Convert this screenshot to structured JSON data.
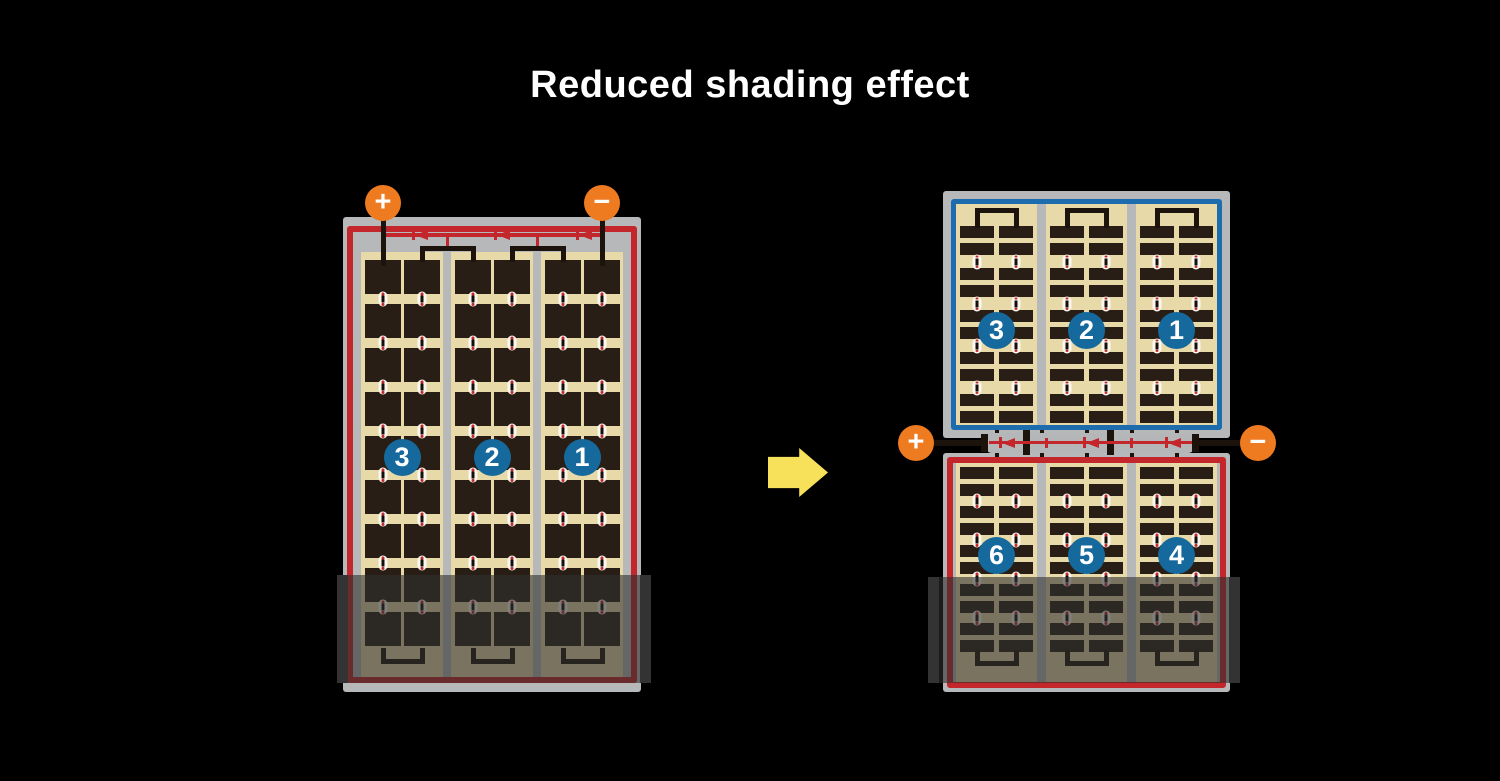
{
  "title": "Reduced shading effect",
  "left_panel": {
    "positive": "+",
    "negative": "−",
    "sections": [
      "3",
      "2",
      "1"
    ]
  },
  "right_panel": {
    "positive": "+",
    "negative": "−",
    "top_sections": [
      "3",
      "2",
      "1"
    ],
    "bottom_sections": [
      "6",
      "5",
      "4"
    ]
  },
  "colors": {
    "background": "#000000",
    "frame_gray": "#b7b8ba",
    "border_red": "#c3272b",
    "border_blue": "#1d6cad",
    "cell_background_tan": "#e8d9a9",
    "cell_dark": "#281e15",
    "terminal_orange": "#ef7b21",
    "number_circle_blue": "#16699c",
    "arrow_yellow": "#f7e05a"
  }
}
